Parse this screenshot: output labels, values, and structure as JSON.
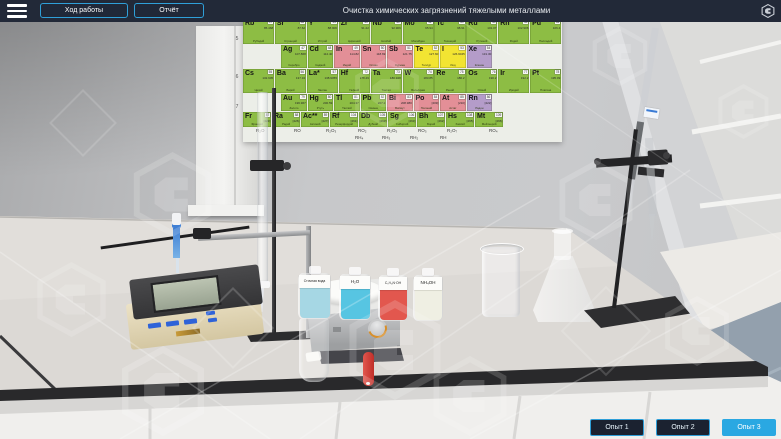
{
  "topbar": {
    "title": "Очистка химических загрязнений тяжелыми металлами",
    "progress_button": "Ход работы",
    "report_button": "Отчёт",
    "menu_icon": "hamburger-icon",
    "brand_icon": "hexagon-logo-icon"
  },
  "experiments": [
    {
      "label": "Опыт 1",
      "active": false
    },
    {
      "label": "Опыт 2",
      "active": false
    },
    {
      "label": "Опыт 3",
      "active": true
    }
  ],
  "colors": {
    "accent_blue": "#2f9fd8",
    "active_button_bg": "#2aa8e2",
    "topbar_bg": "#222938"
  },
  "poster": {
    "periods": [
      "5",
      "6",
      "7"
    ],
    "header": [
      {
        "n": "Медь",
        "c": "g"
      },
      {
        "n": "Цинк",
        "c": "g"
      },
      {
        "n": "Галлий",
        "c": "g"
      },
      {
        "n": "Германий",
        "c": "p"
      },
      {
        "n": "Мышьяк",
        "c": "y"
      },
      {
        "n": "Селен",
        "c": "y"
      },
      {
        "n": "Бром",
        "c": "y"
      },
      {
        "n": "Криптон",
        "c": "v"
      }
    ],
    "rows": [
      [
        {
          "s": "Rb",
          "z": "37",
          "m": "85.468",
          "n": "Рубидий",
          "c": "g"
        },
        {
          "s": "Sr",
          "z": "38",
          "m": "87.62",
          "n": "Стронций",
          "c": "g"
        },
        {
          "s": "Y",
          "z": "39",
          "m": "88.906",
          "n": "Иттрий",
          "c": "g"
        },
        {
          "s": "Zr",
          "z": "40",
          "m": "91.22",
          "n": "Цирконий",
          "c": "g"
        },
        {
          "s": "Nb",
          "z": "41",
          "m": "92.906",
          "n": "Ниобий",
          "c": "g"
        },
        {
          "s": "Mo",
          "z": "42",
          "m": "95.94",
          "n": "Молибден",
          "c": "g"
        },
        {
          "s": "Tc",
          "z": "43",
          "m": "98.91",
          "n": "Технеций",
          "c": "g"
        },
        {
          "s": "Ru",
          "z": "44",
          "m": "101.07",
          "n": "Рутений",
          "c": "g"
        },
        {
          "s": "Rh",
          "z": "45",
          "m": "102.906",
          "n": "Родий",
          "c": "g"
        },
        {
          "s": "Pd",
          "z": "46",
          "m": "106.4",
          "n": "Палладий",
          "c": "g"
        }
      ],
      [
        {
          "s": "Ag",
          "z": "47",
          "m": "107.868",
          "n": "Серебро",
          "c": "g"
        },
        {
          "s": "Cd",
          "z": "48",
          "m": "112.40",
          "n": "Кадмий",
          "c": "g"
        },
        {
          "s": "In",
          "z": "49",
          "m": "114.82",
          "n": "Индий",
          "c": "p"
        },
        {
          "s": "Sn",
          "z": "50",
          "m": "118.69",
          "n": "Олово",
          "c": "p"
        },
        {
          "s": "Sb",
          "z": "51",
          "m": "121.75",
          "n": "Сурьма",
          "c": "p"
        },
        {
          "s": "Te",
          "z": "52",
          "m": "127.60",
          "n": "Теллур",
          "c": "y"
        },
        {
          "s": "I",
          "z": "53",
          "m": "126.9045",
          "n": "Иод",
          "c": "y"
        },
        {
          "s": "Xe",
          "z": "54",
          "m": "131.30",
          "n": "Ксенон",
          "c": "v"
        }
      ],
      [
        {
          "s": "Cs",
          "z": "55",
          "m": "132.905",
          "n": "Цезий",
          "c": "g"
        },
        {
          "s": "Ba",
          "z": "56",
          "m": "137.34",
          "n": "Барий",
          "c": "g"
        },
        {
          "s": "La*",
          "z": "57",
          "m": "138.9055",
          "n": "Лантан",
          "c": "g"
        },
        {
          "s": "Hf",
          "z": "72",
          "m": "178.49",
          "n": "Гафний",
          "c": "g"
        },
        {
          "s": "Ta",
          "z": "73",
          "m": "180.948",
          "n": "Тантал",
          "c": "g"
        },
        {
          "s": "W",
          "z": "74",
          "m": "183.85",
          "n": "Вольфрам",
          "c": "g"
        },
        {
          "s": "Re",
          "z": "75",
          "m": "186.2",
          "n": "Рений",
          "c": "g"
        },
        {
          "s": "Os",
          "z": "76",
          "m": "190.2",
          "n": "Осмий",
          "c": "g"
        },
        {
          "s": "Ir",
          "z": "77",
          "m": "192.2",
          "n": "Иридий",
          "c": "g"
        },
        {
          "s": "Pt",
          "z": "78",
          "m": "195.09",
          "n": "Платина",
          "c": "g"
        }
      ],
      [
        {
          "s": "Au",
          "z": "79",
          "m": "196.967",
          "n": "Золото",
          "c": "g"
        },
        {
          "s": "Hg",
          "z": "80",
          "m": "200.59",
          "n": "Ртуть",
          "c": "g"
        },
        {
          "s": "Tl",
          "z": "81",
          "m": "204.37",
          "n": "Таллий",
          "c": "g"
        },
        {
          "s": "Pb",
          "z": "82",
          "m": "207.2",
          "n": "Свинец",
          "c": "g"
        },
        {
          "s": "Bi",
          "z": "83",
          "m": "208.980",
          "n": "Висмут",
          "c": "p"
        },
        {
          "s": "Po",
          "z": "84",
          "m": "[209]",
          "n": "Полоний",
          "c": "p"
        },
        {
          "s": "At",
          "z": "85",
          "m": "[210]",
          "n": "Астат",
          "c": "p"
        },
        {
          "s": "Rn",
          "z": "86",
          "m": "[222]",
          "n": "Радон",
          "c": "v"
        }
      ],
      [
        {
          "s": "Fr",
          "z": "87",
          "m": "[223]",
          "n": "Франций",
          "c": "g"
        },
        {
          "s": "Ra",
          "z": "88",
          "m": "[226]",
          "n": "Радий",
          "c": "g"
        },
        {
          "s": "Ac**",
          "z": "89",
          "m": "[227]",
          "n": "Актиний",
          "c": "g"
        },
        {
          "s": "Rf",
          "z": "104",
          "m": "[261]",
          "n": "Резерфордий",
          "c": "g"
        },
        {
          "s": "Db",
          "z": "105",
          "m": "[262]",
          "n": "Дубний",
          "c": "g"
        },
        {
          "s": "Sg",
          "z": "106",
          "m": "[263]",
          "n": "Сиборгий",
          "c": "g"
        },
        {
          "s": "Bh",
          "z": "107",
          "m": "[262]",
          "n": "Борий",
          "c": "g"
        },
        {
          "s": "Hs",
          "z": "108",
          "m": "[265]",
          "n": "Хассий",
          "c": "g"
        },
        {
          "s": "Mt",
          "z": "109",
          "m": "[266]",
          "n": "Мейтнерий",
          "c": "g"
        }
      ]
    ],
    "oxides": [
      "R₂O",
      "RO",
      "R₂O₃",
      "RO₂",
      "R₂O₅",
      "RO₃",
      "R₂O₇",
      "RO₄"
    ],
    "hydrides": [
      "RH₄",
      "RH₃",
      "RH₂",
      "RH"
    ]
  },
  "bench": {
    "bottles": [
      {
        "label": "Сточная вода",
        "liquid_color": "#a6d7e4"
      },
      {
        "label": "H₂O",
        "liquid_color": "#57c5e2"
      },
      {
        "label": "C₉H₆N·OH",
        "liquid_color": "#e2574e"
      },
      {
        "label": "NH₄OH",
        "liquid_color": "#efefe3"
      }
    ]
  }
}
